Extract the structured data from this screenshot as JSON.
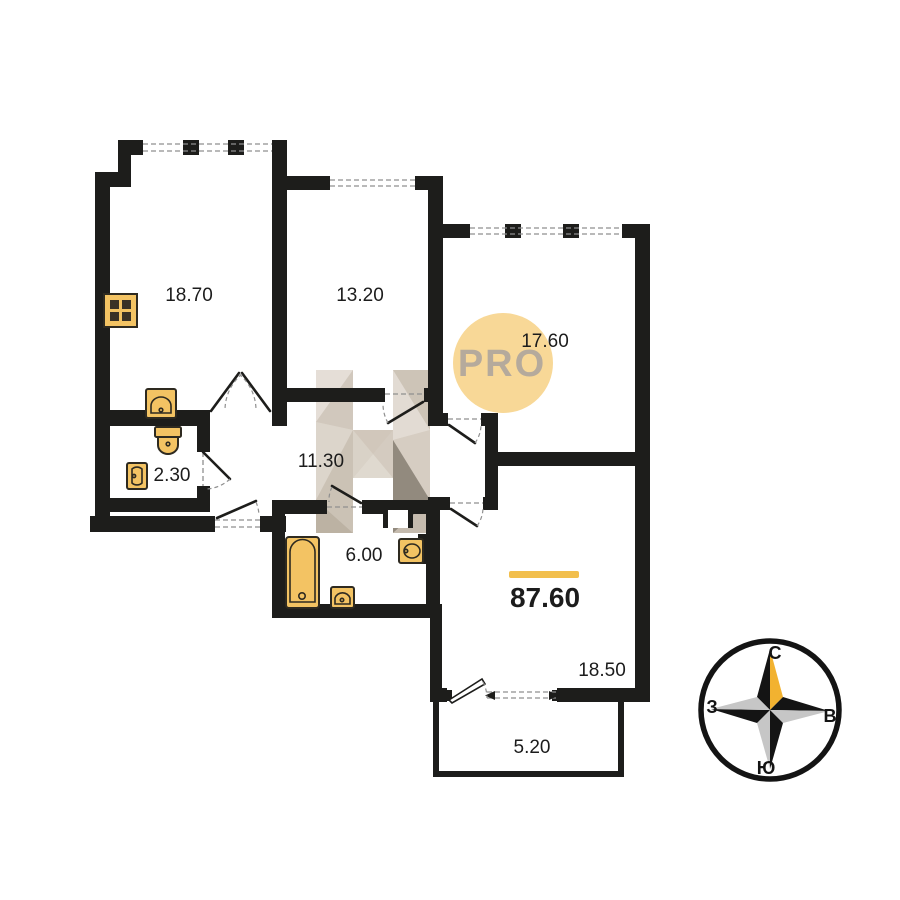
{
  "plan": {
    "total_area": "87.60",
    "rooms": [
      {
        "area": "18.70"
      },
      {
        "area": "13.20"
      },
      {
        "area": "17.60"
      },
      {
        "area": "2.30"
      },
      {
        "area": "11.30"
      },
      {
        "area": "6.00"
      },
      {
        "area": "18.50"
      },
      {
        "area": "5.20"
      }
    ]
  },
  "watermarks": {
    "badge_text": "PRO",
    "logo_letter": "H"
  },
  "compass": {
    "north_label": "С",
    "east_label": "В",
    "south_label": "Ю",
    "west_label": "З"
  },
  "colors": {
    "wall": "#1d1d1b",
    "fixture_fill": "#f3c363",
    "accent_bar": "#f2bf4d",
    "badge_bg": "#f8d897",
    "badge_text": "#b5aa9c",
    "compass_gold": "#f2b230",
    "compass_gray": "#c6c6c6"
  }
}
